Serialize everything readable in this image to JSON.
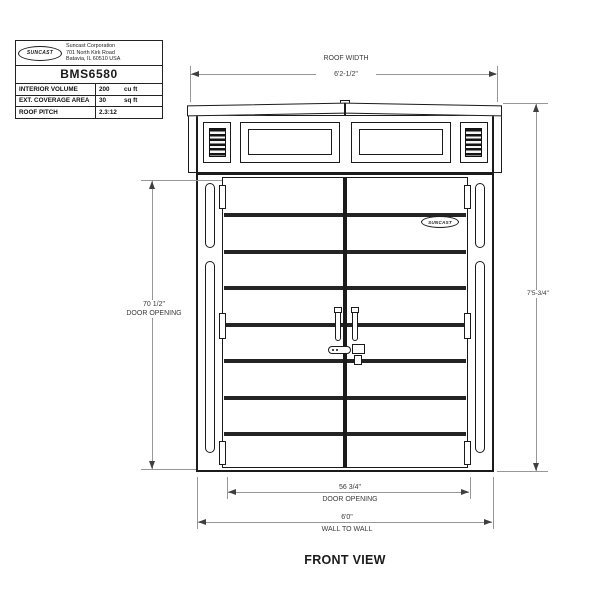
{
  "title_block": {
    "logo_text": "SUNCAST",
    "address": [
      "Suncast Corporation",
      "701 North Kirk Road",
      "Batavia, IL 60510 USA"
    ],
    "model": "BMS6580",
    "specs": [
      {
        "label": "INTERIOR VOLUME",
        "value": "200",
        "unit": "cu ft"
      },
      {
        "label": "EXT. COVERAGE AREA",
        "value": "30",
        "unit": "sq ft"
      },
      {
        "label": "ROOF PITCH",
        "value": "2.3:12",
        "unit": ""
      }
    ]
  },
  "dimensions": {
    "roof_width": {
      "label": "ROOF WIDTH",
      "value": "6'2-1/2\""
    },
    "overall_height": {
      "value": "7'5-3/4\""
    },
    "door_opening_height": {
      "value": "70 1/2\"",
      "label": "DOOR OPENING"
    },
    "door_opening_width": {
      "value": "56 3/4\"",
      "label": "DOOR OPENING"
    },
    "wall_to_wall": {
      "value": "6'0\"",
      "label": "WALL TO WALL"
    }
  },
  "shed": {
    "door_logo_text": "SUNCAST"
  },
  "caption": "FRONT VIEW"
}
